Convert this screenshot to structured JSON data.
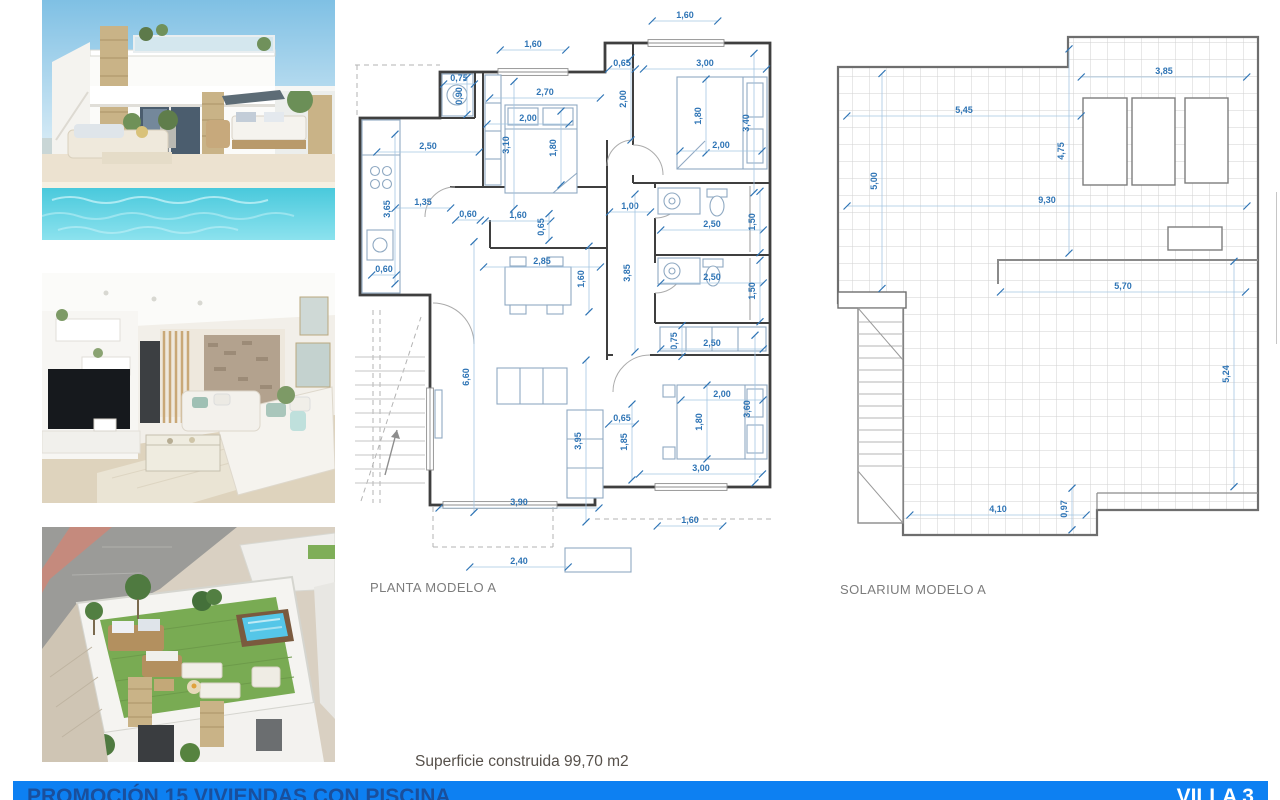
{
  "page": {
    "width": 1280,
    "height": 800,
    "background": "#ffffff"
  },
  "photos": [
    {
      "id": "villa-exterior",
      "description": "Render of modern villa with stone pillars, terrace and private pool"
    },
    {
      "id": "living-room",
      "description": "Render of living room interior with TV wall, sofas and stone feature wall"
    },
    {
      "id": "rooftop-solarium",
      "description": "Aerial render of rooftop solarium with lawn, jacuzzi and lounge furniture"
    }
  ],
  "floor_plan": {
    "label": "PLANTA MODELO A",
    "scale_px_per_m": 41,
    "dimensions": [
      {
        "t": "1,60",
        "x": 178,
        "y": 39,
        "o": "h"
      },
      {
        "t": "1,60",
        "x": 330,
        "y": 10,
        "o": "h"
      },
      {
        "t": "0,65",
        "x": 267,
        "y": 58,
        "o": "h"
      },
      {
        "t": "3,00",
        "x": 350,
        "y": 58,
        "o": "h"
      },
      {
        "t": "0,75",
        "x": 104,
        "y": 73,
        "o": "h"
      },
      {
        "t": "0,90",
        "x": 104,
        "y": 91,
        "o": "v"
      },
      {
        "t": "2,70",
        "x": 190,
        "y": 87,
        "o": "h"
      },
      {
        "t": "2,00",
        "x": 268,
        "y": 94,
        "o": "v"
      },
      {
        "t": "2,00",
        "x": 173,
        "y": 113,
        "o": "h"
      },
      {
        "t": "3,10",
        "x": 151,
        "y": 140,
        "o": "v"
      },
      {
        "t": "1,80",
        "x": 198,
        "y": 143,
        "o": "v"
      },
      {
        "t": "1,80",
        "x": 343,
        "y": 111,
        "o": "v"
      },
      {
        "t": "3,40",
        "x": 391,
        "y": 118,
        "o": "v"
      },
      {
        "t": "2,00",
        "x": 366,
        "y": 140,
        "o": "h"
      },
      {
        "t": "2,50",
        "x": 73,
        "y": 141,
        "o": "h"
      },
      {
        "t": "3,65",
        "x": 32,
        "y": 204,
        "o": "v"
      },
      {
        "t": "1,35",
        "x": 68,
        "y": 197,
        "o": "h"
      },
      {
        "t": "0,60",
        "x": 113,
        "y": 209,
        "o": "h"
      },
      {
        "t": "1,60",
        "x": 163,
        "y": 210,
        "o": "h"
      },
      {
        "t": "0,65",
        "x": 186,
        "y": 222,
        "o": "v"
      },
      {
        "t": "1,00",
        "x": 275,
        "y": 201,
        "o": "h"
      },
      {
        "t": "0,60",
        "x": 29,
        "y": 264,
        "o": "h"
      },
      {
        "t": "2,85",
        "x": 187,
        "y": 256,
        "o": "h"
      },
      {
        "t": "1,60",
        "x": 226,
        "y": 274,
        "o": "v"
      },
      {
        "t": "3,85",
        "x": 272,
        "y": 268,
        "o": "v"
      },
      {
        "t": "2,50",
        "x": 357,
        "y": 219,
        "o": "h"
      },
      {
        "t": "1,50",
        "x": 397,
        "y": 217,
        "o": "v"
      },
      {
        "t": "2,50",
        "x": 357,
        "y": 272,
        "o": "h"
      },
      {
        "t": "1,50",
        "x": 397,
        "y": 286,
        "o": "v"
      },
      {
        "t": "0,75",
        "x": 319,
        "y": 336,
        "o": "v"
      },
      {
        "t": "2,50",
        "x": 357,
        "y": 338,
        "o": "h"
      },
      {
        "t": "6,60",
        "x": 111,
        "y": 372,
        "o": "v"
      },
      {
        "t": "0,65",
        "x": 267,
        "y": 413,
        "o": "h"
      },
      {
        "t": "2,00",
        "x": 367,
        "y": 389,
        "o": "h"
      },
      {
        "t": "1,80",
        "x": 344,
        "y": 417,
        "o": "v"
      },
      {
        "t": "3,60",
        "x": 392,
        "y": 404,
        "o": "v"
      },
      {
        "t": "3,95",
        "x": 223,
        "y": 436,
        "o": "v"
      },
      {
        "t": "1,85",
        "x": 269,
        "y": 437,
        "o": "v"
      },
      {
        "t": "3,00",
        "x": 346,
        "y": 463,
        "o": "h"
      },
      {
        "t": "3,90",
        "x": 164,
        "y": 497,
        "o": "h"
      },
      {
        "t": "1,60",
        "x": 335,
        "y": 515,
        "o": "h"
      },
      {
        "t": "2,40",
        "x": 164,
        "y": 556,
        "o": "h"
      }
    ]
  },
  "solarium_plan": {
    "label": "SOLARIUM MODELO A",
    "scale_px_per_m": 43,
    "dimensions": [
      {
        "t": "3,85",
        "x": 329,
        "y": 46,
        "o": "h"
      },
      {
        "t": "5,45",
        "x": 129,
        "y": 85,
        "o": "h"
      },
      {
        "t": "4,75",
        "x": 226,
        "y": 126,
        "o": "v"
      },
      {
        "t": "5,00",
        "x": 39,
        "y": 156,
        "o": "v"
      },
      {
        "t": "9,30",
        "x": 212,
        "y": 175,
        "o": "h"
      },
      {
        "t": "5,70",
        "x": 288,
        "y": 261,
        "o": "h"
      },
      {
        "t": "5,24",
        "x": 391,
        "y": 349,
        "o": "v"
      },
      {
        "t": "4,10",
        "x": 163,
        "y": 484,
        "o": "h"
      },
      {
        "t": "0,97",
        "x": 229,
        "y": 484,
        "o": "v"
      }
    ]
  },
  "footer": {
    "area_label": "Superficie construida 99,70 m2",
    "banner": {
      "left": "PROMOCIÓN 15 VIVIENDAS CON PISCINA",
      "right": "VILLA 3",
      "color": "#0d80f2"
    }
  },
  "colors": {
    "dimension_text": "#2e74b5",
    "dimension_line": "#a5c6e2",
    "walls": "#3f3f3f",
    "caption": "#7c7c7c"
  }
}
